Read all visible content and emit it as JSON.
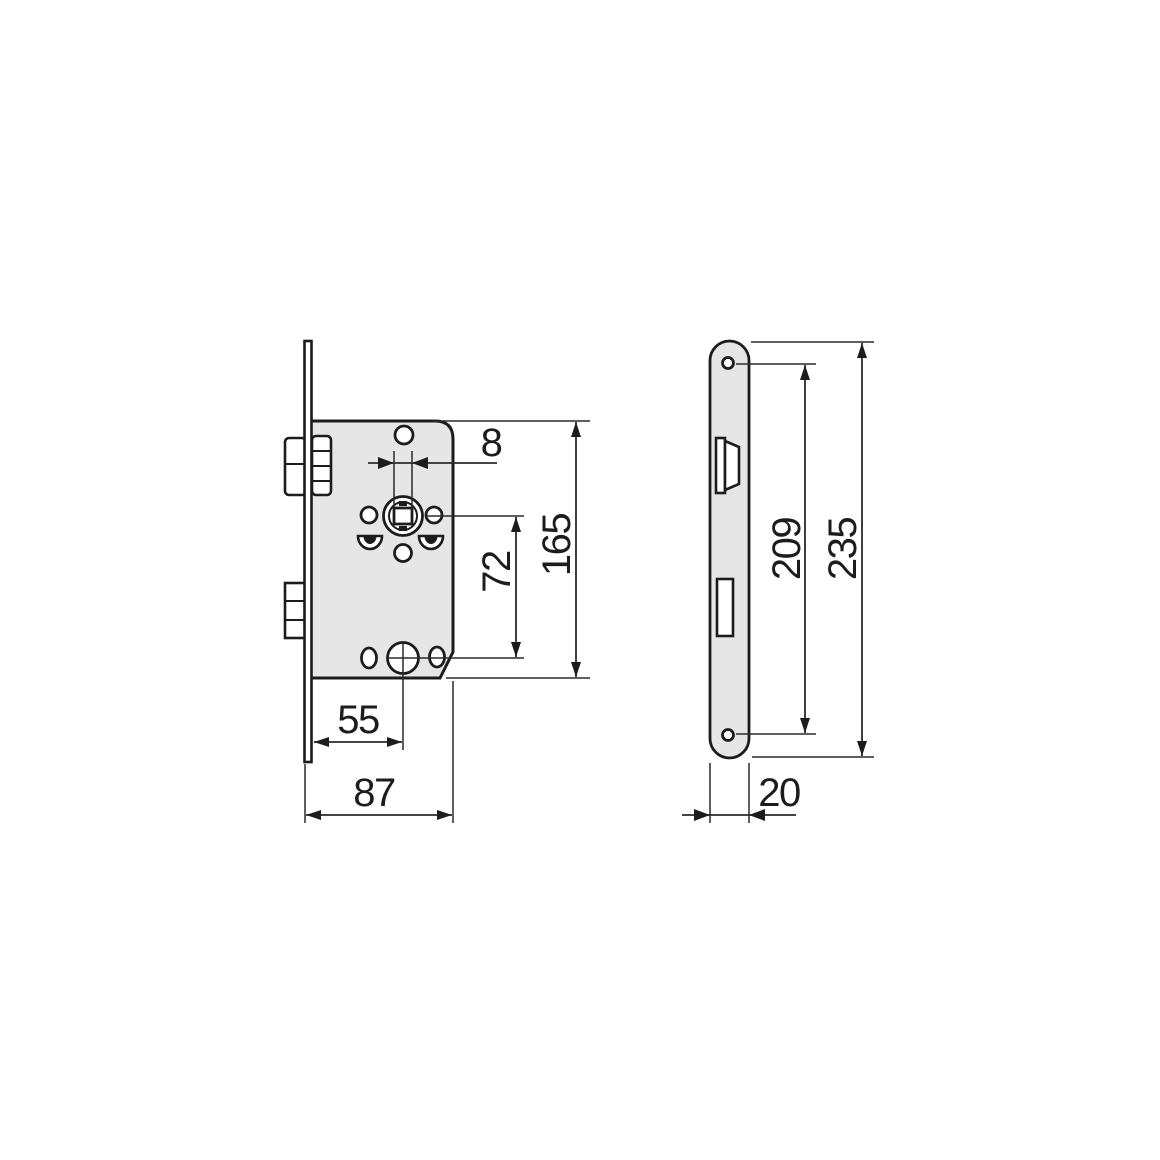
{
  "drawing": {
    "kind": "mortise-lock-dimension-drawing",
    "colors": {
      "part_fill": "#e6e6e6",
      "line": "#1c1c1c",
      "background": "#ffffff"
    },
    "side_view": {
      "dims": {
        "follower_square": "8",
        "case_height": "165",
        "axle_distance": "72",
        "backset": "55",
        "case_depth": "87"
      }
    },
    "front_view": {
      "dims": {
        "screw_spacing": "209",
        "faceplate_length": "235",
        "faceplate_width": "20"
      }
    }
  }
}
